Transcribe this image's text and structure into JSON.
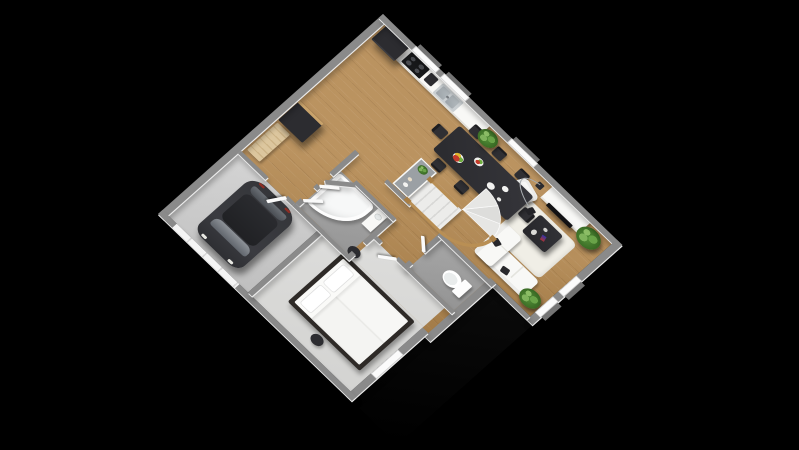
{
  "scene": {
    "kind": "3d-floor-plan-render",
    "floor_label": "Ground floor 3D plan",
    "background": "#000000",
    "colors": {
      "wood_floor": "#b3874f",
      "garage_floor": "#d4d4d4",
      "bedroom_floor": "#e8e8e6",
      "tile_floor": "#a3a3a3",
      "wall_cap": "#8a8a8a",
      "wall_face": "#f2f2f2",
      "dark_furniture": "#2c2c30",
      "white_furniture": "#f8f8f6",
      "wood_accent": "#b98f54",
      "plant_green": "#548f39"
    },
    "rooms": {
      "garage": {
        "label": "Garage",
        "items": [
          "car",
          "garage-door"
        ]
      },
      "entry": {
        "label": "Entry hall",
        "items": [
          "bench",
          "wardrobe",
          "double-open-doors"
        ]
      },
      "kitchen": {
        "label": "Kitchen",
        "items": [
          "refrigerator",
          "cooktop",
          "coffee-machine",
          "sink",
          "counter",
          "peninsula"
        ]
      },
      "dining": {
        "label": "Dining area",
        "items": [
          "dining-table",
          "8-chairs",
          "fruit-plates",
          "potted-plants"
        ]
      },
      "living": {
        "label": "Living room",
        "items": [
          "corner-sofa",
          "armchair",
          "coffee-table",
          "rug",
          "tv-stand",
          "tv",
          "arc-floor-lamp",
          "potted-plant"
        ]
      },
      "bedroom": {
        "label": "Bedroom",
        "items": [
          "double-bed",
          "two-stools"
        ]
      },
      "bathroom": {
        "label": "Bathroom",
        "items": [
          "corner-bathtub",
          "washbasin",
          "vanity"
        ]
      },
      "wc": {
        "label": "WC",
        "items": [
          "toilet"
        ]
      },
      "stairs": {
        "label": "Winder staircase",
        "items": [
          "treads",
          "wood-railing"
        ]
      },
      "hallway": {
        "label": "Hallway",
        "items": []
      }
    },
    "furniture_labels": {
      "car": "Car",
      "bed": "Double bed",
      "bathtub": "Corner bathtub",
      "toilet": "Toilet",
      "sofa": "Corner sofa",
      "armchair": "Armchair",
      "coffee_table": "Coffee table",
      "tv_stand": "TV stand",
      "tv": "TV",
      "dining_table": "Dining table",
      "fridge": "Refrigerator",
      "sink": "Kitchen sink",
      "cooktop": "Cooktop",
      "wardrobe": "Wardrobe",
      "bench": "Bench",
      "stairs": "Staircase",
      "plant": "Potted plant",
      "lamp": "Arc floor lamp"
    },
    "counts": {
      "dining_chairs": 8,
      "plants": 4,
      "open_doors": 5,
      "windows": 6
    }
  }
}
